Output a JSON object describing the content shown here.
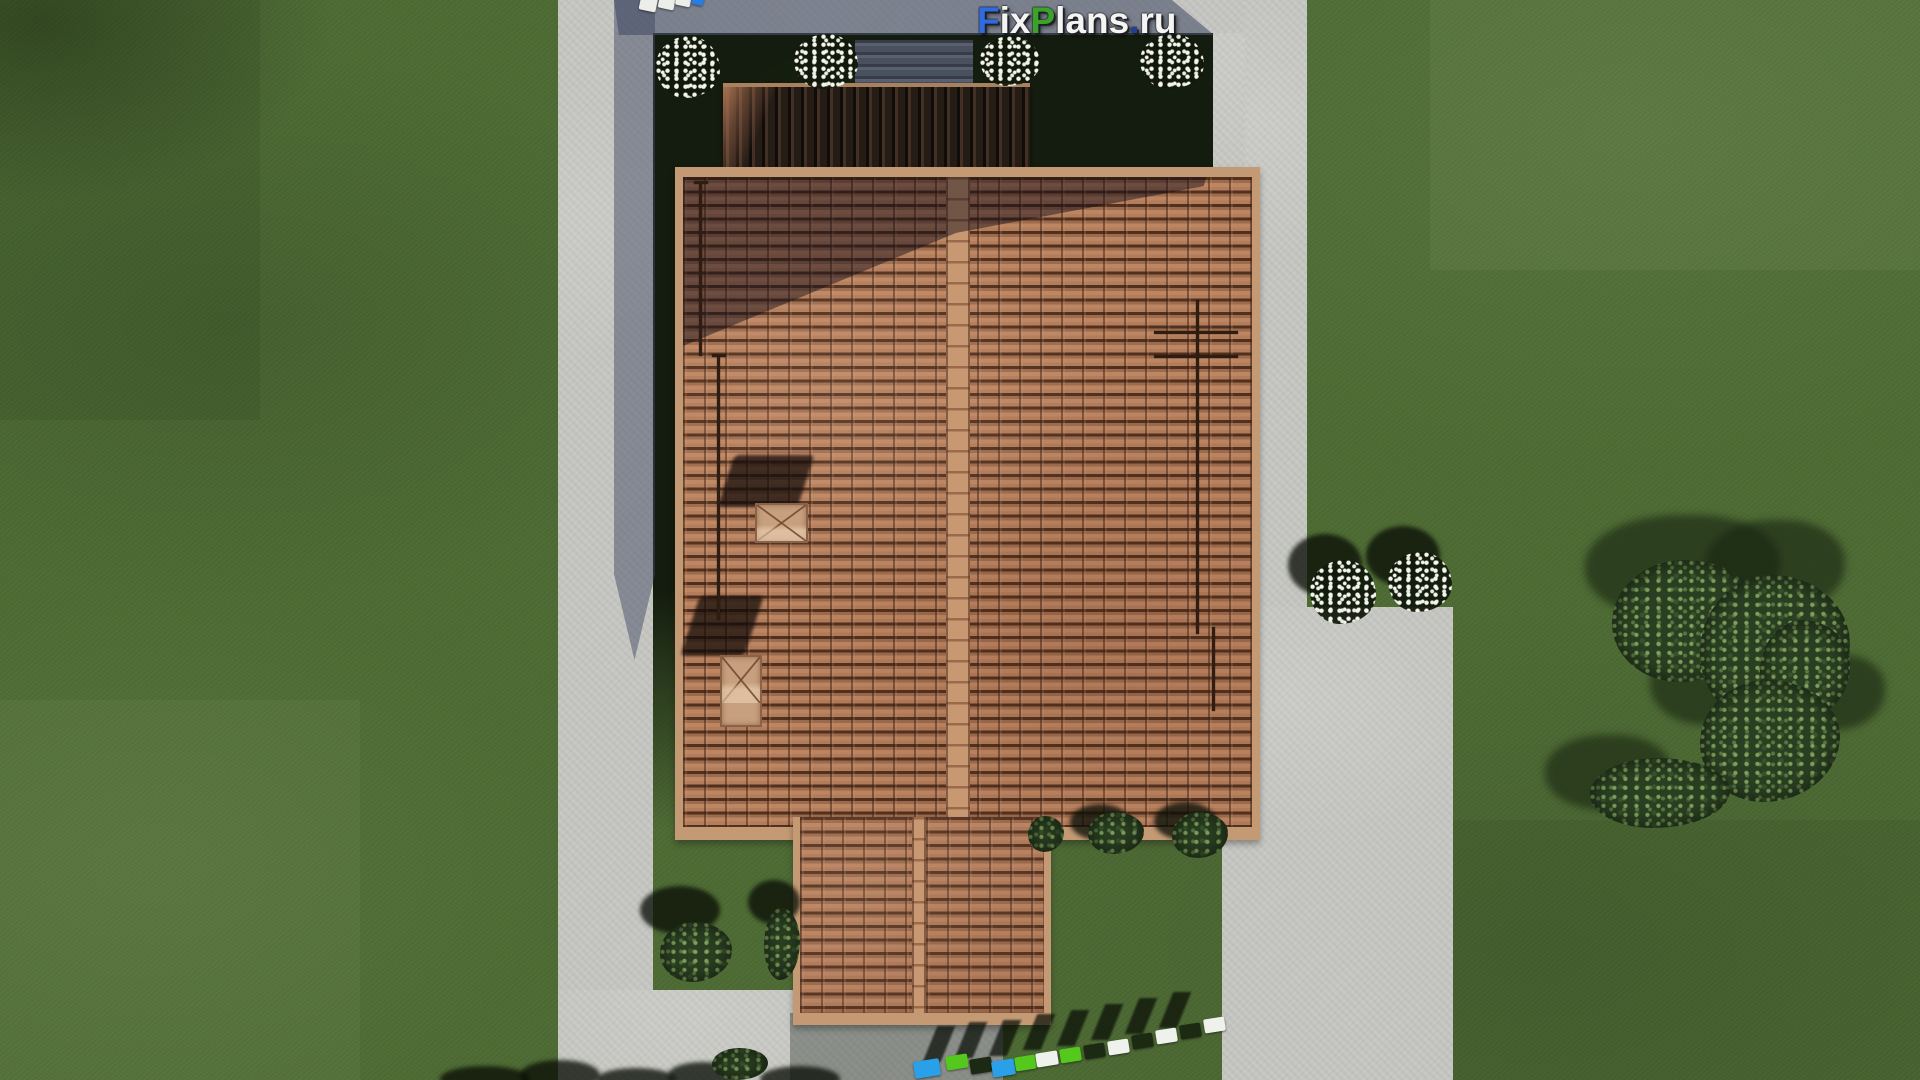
{
  "image_type": "3d-aerial-render",
  "subject": "Top-down 3D visualization of a house with terracotta tile hip roof, concrete walkways, driveway patio, lawn, flower shrubs, trees and colored stepping stones",
  "watermark": {
    "text": "FixPlans.ru",
    "segments": [
      {
        "text": "F",
        "color": "#2e6be0"
      },
      {
        "text": "ix",
        "color": "#f4f4f2"
      },
      {
        "text": "P",
        "color": "#39a427"
      },
      {
        "text": "lans",
        "color": "#f4f4f2"
      },
      {
        "text": ".",
        "color": "#1d4098"
      },
      {
        "text": "ru",
        "color": "#f4f4f2"
      }
    ]
  },
  "palette": {
    "grass": "#4e6b34",
    "garden_bed_shadow": "#131c0e",
    "concrete": "#c8c9c4",
    "concrete_shadow": "#5d657c",
    "roof_tile": "#b07a58",
    "roof_tile_gap": "#50301e",
    "roof_ridge": "#c89873",
    "roof_trim": "#c39a74",
    "porch_roof_shadow": "#241b15",
    "chimney_cap": "#c7a07f",
    "foliage": "#2a3f22",
    "flowers": "#f4f6ee",
    "stone_blue": "#2aa0e8",
    "stone_green": "#54c81c",
    "stone_white": "#eff1ec"
  },
  "scene_elements": [
    "lawn",
    "left-walkway",
    "bottom-walkway",
    "top-driveway",
    "right-walkway",
    "right-patio",
    "flower-bed",
    "main-hip-roof",
    "roof-ridge",
    "porch-roof",
    "terrace-deck",
    "chimneys",
    "snow-guard-rails",
    "white-flower-shrubs",
    "green-shrubs",
    "tree-cluster",
    "stepping-stones",
    "watermark-logo"
  ],
  "stones": {
    "top": [
      {
        "color": "#eceee9"
      },
      {
        "color": "#eceee9"
      },
      {
        "color": "#eceee9"
      },
      {
        "color": "#2a7de0"
      }
    ],
    "bottom": [
      {
        "color": "#2aa0e8"
      },
      {
        "color": "#54c81c"
      },
      {
        "color": "#1c2913"
      },
      {
        "color": "#2aa0e8"
      },
      {
        "color": "#54c81c"
      },
      {
        "color": "#eff1ec"
      },
      {
        "color": "#54c81c"
      },
      {
        "color": "#1c2913"
      },
      {
        "color": "#eff1ec"
      },
      {
        "color": "#1c2913"
      },
      {
        "color": "#eff1ec"
      },
      {
        "color": "#1c2913"
      },
      {
        "color": "#eff1ec"
      }
    ]
  }
}
